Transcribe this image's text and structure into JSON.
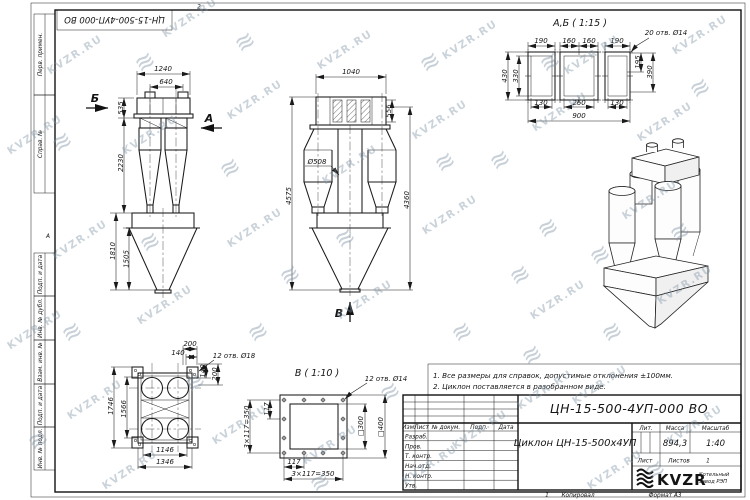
{
  "watermark": {
    "text": "KVZR.RU",
    "logo_glyph": "≋"
  },
  "frame": {
    "stamp_rotated": "ЦН-15-500-4УП-000 ВО",
    "left_column": [
      "Перв. примен.",
      "Справ. №",
      "Подп. и дата",
      "Инв. № дубл.",
      "Взам. инв. №",
      "Подп. и дата",
      "Инв. № подл."
    ],
    "zone_top": "2",
    "zone_bottom": "1",
    "zone_left": "А"
  },
  "front_view": {
    "dim_width_total": "1240",
    "dim_width_inner": "640",
    "dim_h1": "535",
    "dim_h2": "2230",
    "dim_h3": "1810",
    "dim_h4": "1505",
    "arrow_b": "Б",
    "arrow_a": "А"
  },
  "side_view": {
    "dim_width_top": "1040",
    "dim_inlet_h": "556",
    "dim_dia": "Ø508",
    "dim_h_total": "4575",
    "dim_h_right": "4360",
    "arrow_v": "В"
  },
  "section_ab": {
    "title": "А,Б ( 1:15 )",
    "callout": "20 отв. Ø14",
    "dim_top": [
      "190",
      "160",
      "160",
      "190"
    ],
    "dim_left_outer": "430",
    "dim_left_inner": "330",
    "dim_right_inner": "195",
    "dim_right_outer": "390",
    "dim_bottom": [
      "130",
      "260",
      "130"
    ],
    "dim_bottom_total": "900"
  },
  "plan_view": {
    "callout": "12 отв. Ø18",
    "dim_top_1": "200",
    "dim_top_2": "140",
    "dim_right_1": "140",
    "dim_right_2": "200",
    "dim_left_outer": "1746",
    "dim_left_inner": "1566",
    "dim_bottom_inner": "1146",
    "dim_bottom_outer": "1346"
  },
  "section_v": {
    "title": "В ( 1:10 )",
    "callout": "12 отв. Ø14",
    "dim_left_117": "117",
    "dim_left_pitch": "3×117=350",
    "dim_sq_inner": "□300",
    "dim_sq_outer": "□400",
    "dim_bottom_117": "117",
    "dim_bottom_pitch": "3×117=350"
  },
  "notes": [
    "1. Все размеры для справок, допустимые отклонения ±100мм.",
    "2. Циклон поставляется в разобранном виде."
  ],
  "title_block": {
    "doc_number": "ЦН-15-500-4УП-000 ВО",
    "product_name": "Циклон ЦН-15-500х4УП",
    "col_headers": [
      "Изм.",
      "Лист",
      "№ докум.",
      "Подп.",
      "Дата"
    ],
    "sign_rows": [
      "Разраб.",
      "Пров.",
      "Т. контр.",
      "Нач.отд.",
      "Н. контр.",
      "Утв."
    ],
    "lit_label": "Лит.",
    "mass_label": "Масса",
    "scale_label": "Масштаб",
    "mass_value": "894,3",
    "scale_value": "1:40",
    "sheet_label": "Лист",
    "sheets_label": "Листов",
    "sheets_value": "1",
    "logo_text": "KVZR",
    "logo_sub1": "Котельный",
    "logo_sub2": "завод РЭП",
    "footer_copy": "Копировал",
    "footer_format": "Формат А3"
  }
}
